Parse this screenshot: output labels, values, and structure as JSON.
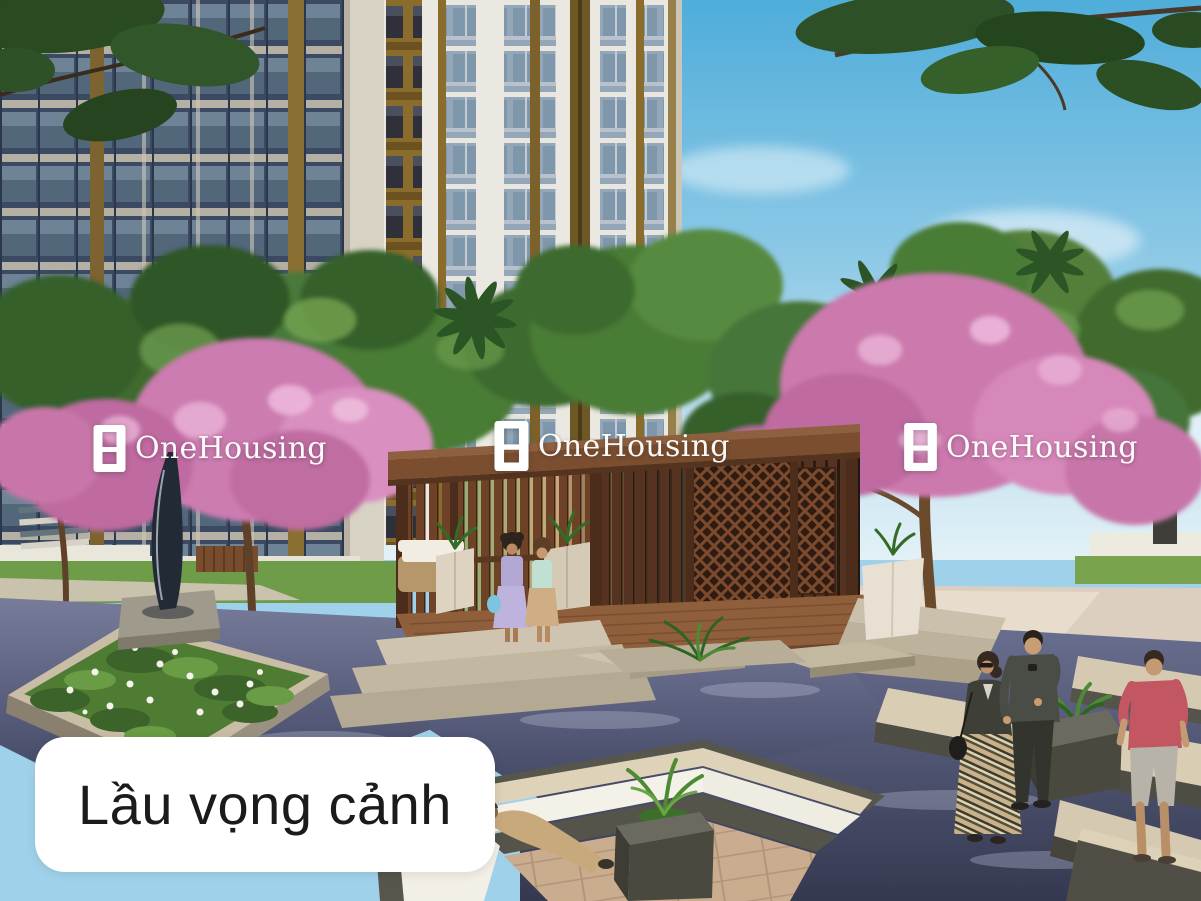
{
  "watermarks": [
    {
      "text": "OneHousing"
    },
    {
      "text": "OneHousing"
    },
    {
      "text": "OneHousing"
    }
  ],
  "caption": {
    "text": "Lầu vọng cảnh"
  },
  "colors": {
    "sky_top": "#4fadda",
    "sky_horizon": "#e3f1f7",
    "foliage_green": "#4a7c36",
    "foliage_green_dark": "#35602a",
    "blossom_pink": "#cc79ae",
    "blossom_pink_light": "#e7aed3",
    "pavilion_wood": "#6e4227",
    "deck_wood": "#8f5f3c",
    "stone_light": "#cfc4b0",
    "stone_dark": "#55544a",
    "water_light": "#777c9a",
    "water_deep": "#3d425c",
    "pool_teal": "#49b7c6",
    "grass_green": "#6f9c48",
    "caption_bg": "#ffffff",
    "caption_text": "#1b1b1d",
    "watermark_text": "#ffffff"
  }
}
